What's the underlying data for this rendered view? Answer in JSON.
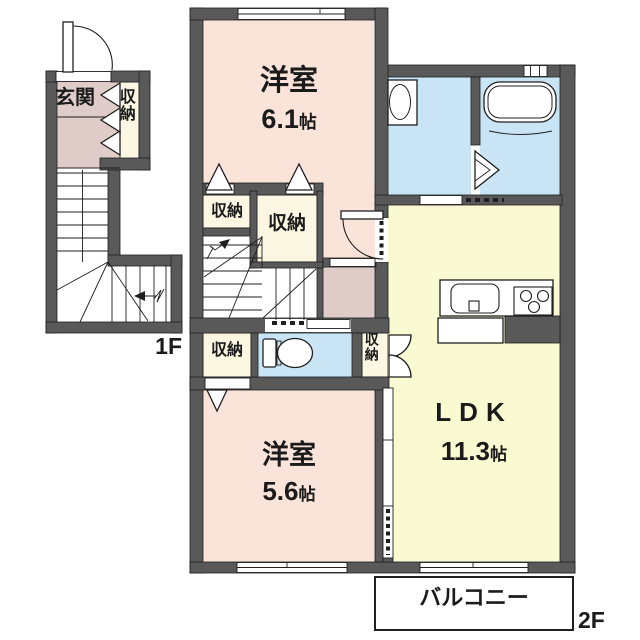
{
  "title": "2階建メゾネット間取り図",
  "colors": {
    "wall": "#595959",
    "line": "#1f1f1f",
    "room_pink": "#fae4d9",
    "hall_mauve": "#dfccc8",
    "closet_cream": "#fbf7e2",
    "water_blue": "#c9e4f4",
    "ldk_yellow": "#f9f9d2",
    "text": "#1b1b1b"
  },
  "floor1": {
    "floor_label": "1F",
    "entrance_label": "玄関",
    "closet_label": "収納"
  },
  "floor2": {
    "floor_label": "2F",
    "bedroom_top": {
      "name": "洋室",
      "size_num": "6.1",
      "size_unit": "帖"
    },
    "bedroom_bottom": {
      "name": "洋室",
      "size_num": "5.6",
      "size_unit": "帖"
    },
    "ldk": {
      "name": "LDK",
      "size_num": "11.3",
      "size_unit": "帖"
    },
    "closet_upper_left": "収納",
    "closet_upper_right": "収納",
    "closet_lower_left": "収納",
    "closet_lower_right": "収納",
    "balcony_label": "バルコニー"
  }
}
